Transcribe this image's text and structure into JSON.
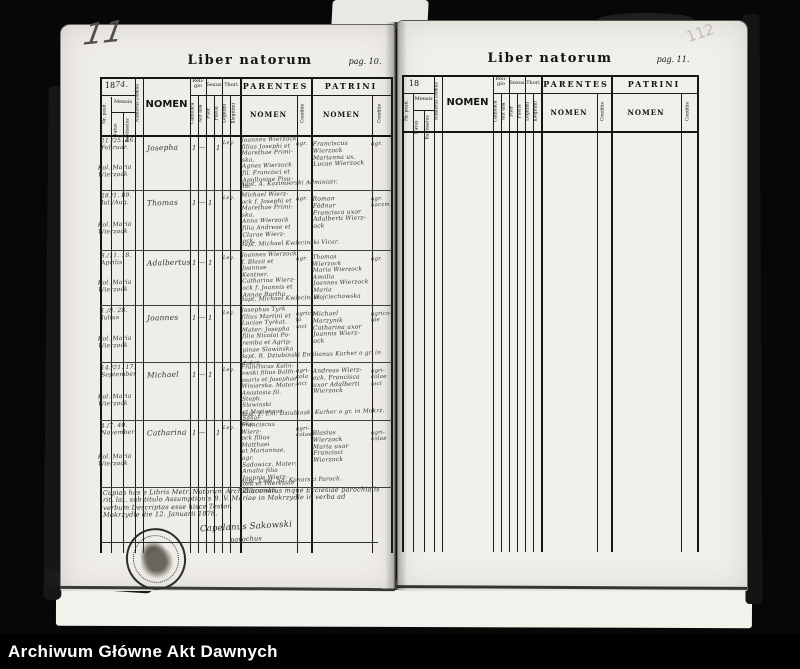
{
  "footer": {
    "label": "Archiwum Główne Akt Dawnych"
  },
  "pencil": {
    "left_page_number": "11",
    "right_page_number": "112"
  },
  "table_headers": {
    "nr_posit": "Nr. posit.",
    "mensis": "Mensis",
    "natus": "Natus",
    "baptisatus": "Baptisatus",
    "numerus_domus": "Numerus Domus",
    "nomen_main": "NOMEN",
    "religio": "Reli-\ngio",
    "catholica": "Catholica",
    "aut_alia": "Aut alia",
    "sexus": "Sexus",
    "puer": "Puer",
    "puella": "Puella",
    "thori": "Thori",
    "legitimi": "Legitimi",
    "illegitimi": "Illegitimi",
    "parentes": "PARENTES",
    "patrini": "PATRINI",
    "nomen_sub": "NOMEN",
    "conditio": "Conditio"
  },
  "left_page": {
    "title": "Liber natorum",
    "page_label": "pag. 10.",
    "year_printed": "18",
    "year_hand": "74.",
    "entries": [
      {
        "dates": "21./25. 46.\nFebruar.",
        "place": "Kol. Maria\nWierzock",
        "nomen": "Josepha",
        "religio_mark": "1",
        "aut_mark": "—",
        "sexus_mark": "1",
        "thori_mark": "Leg.",
        "parentes": "Joannes Wierzock\nfilius Josephi et\nMarethae Primi-\nska.\nAgnes Wierzock\nfil. Francisci et\nApolloniae Pisu-\nla.",
        "parentes_conditio": "agr.",
        "patrini": "Franciscus\nWierzock\nMarianna ux.\nLucae Wierzock",
        "patrini_conditio": "agr.",
        "footline": "Bapt. A. Kazimierski Administr."
      },
      {
        "dates": "28./1. 89.\nJul./Aug.",
        "place": "Kol. Maria\nWierzock",
        "nomen": "Thomas",
        "religio_mark": "1",
        "aut_mark": "—",
        "sexus_mark": "1",
        "thori_mark": "Leg.",
        "parentes": "Michael Wierz-\nock f. Josephi et\nMarethae Primi-\nska.\nAnna Wierzock\nfilia Andreae et\nClarae Wierz-\nock.",
        "parentes_conditio": "agr.",
        "patrini": "Roman\nFödnar\nFrancisca uxor\nAdalberti Wierz-\nock",
        "patrini_conditio": "agr.\nkaczm.",
        "footline": "Bapt. Michael Kwiecinski Vicar."
      },
      {
        "dates": "8./11. 18.\nAprilis",
        "place": "Kol. Maria\nWierzock",
        "nomen": "Adalbertus",
        "religio_mark": "1",
        "aut_mark": "—",
        "sexus_mark": "1",
        "thori_mark": "Leg.",
        "parentes": "Joannes Wierzock\nf. Blasii et Joannae\nKentner.\nCatharina Wierz-\nock f. Joannis et\nAnnae Bartha",
        "parentes_conditio": "agr.",
        "patrini": "Thomas\nWierzock\nMaria Wierzock\nAmalia\nJoannes Wierzock\nMaria Wojciechowska",
        "patrini_conditio": "agr.",
        "footline": "Bapt. Michael Kwiecinski."
      },
      {
        "dates": "1./8. 28.\nJulius",
        "place": "Kol. Maria\nWierzock",
        "nomen": "Joannes",
        "religio_mark": "1",
        "aut_mark": "—",
        "sexus_mark": "1",
        "thori_mark": "Leg.",
        "parentes": "Josephus Tyrk\nfilius Martini et\nLuciae Tyrkat.\nMater: Josepha\nfilia Nicolai Po-\nremba et Agrip-\npinae Slawinska",
        "parentes_conditio": "agrico-\nla\nloci",
        "patrini": "Michael\nMarzynik\nCatharina uxor\nJoannis Wierz-\nock",
        "patrini_conditio": "agrico-\nlae",
        "footline": "Bapt. R. Dziubinski Emilianus Kurher o gr. in Mokrz."
      },
      {
        "dates": "14./21. 17.\nSeptember",
        "place": "Kol. Maria\nWierzock",
        "nomen": "Michael",
        "religio_mark": "1",
        "aut_mark": "—",
        "sexus_mark": "1",
        "thori_mark": "Leg.",
        "parentes": "Franciscus Kalin-\nowski filius Balth-\nasaris et Josephae\nWiniarska. Mater:\nAnastasia fil. Steph.\nSlawinski\net Mariannae Sakal-\nska.",
        "parentes_conditio": "agri-\ncola\nloci",
        "patrini": "Andreas Wierz-\nock, Francisca\nuxor Adalberti\nWierzock",
        "patrini_conditio": "agri-\ncolae\nloci",
        "footline": "Bapt. P. Em. Dziubinski Kurher o gr. in Mokrz."
      },
      {
        "dates": "4./7. 40.\nNovember",
        "place": "Kol. Maria\nWierzock",
        "nomen": "Catharina",
        "religio_mark": "1",
        "aut_mark": "—",
        "sexus_mark": "1",
        "thori_mark": "Leg.",
        "parentes": "Franciscus Wierz-\nock filius Matthaei\net Mariannae, agr.\nSadowicz. Mater:\nAmalia filia\nJoannis Wierz-\nock et Theresiae\nŻabronska.",
        "parentes_conditio": "agri-\ncolae",
        "patrini": "Blasius\nWierzock\nMaria uxor\nFrancisci\nWierzock",
        "patrini_conditio": "agri-\ncolae",
        "footline": "Bapt. Capl. Sa. Konarski Paroch."
      }
    ],
    "certification": {
      "text": "Copias has e Libris Metr. Natorum Archidiaconatus mque Ecclesiae parochialis\nrit. lat. sub titulo Assumptionis B. V. Mariae in Mokrzydle in verba ad\nverbum Descriptas esse hisce Testor.\nMokrzydle die 12. Januarii 1878.",
      "signature": "Capelanus Sakowski",
      "signature_role": "parochus"
    }
  },
  "right_page": {
    "title": "Liber natorum",
    "page_label": "pag. 11.",
    "year_printed": "18"
  }
}
